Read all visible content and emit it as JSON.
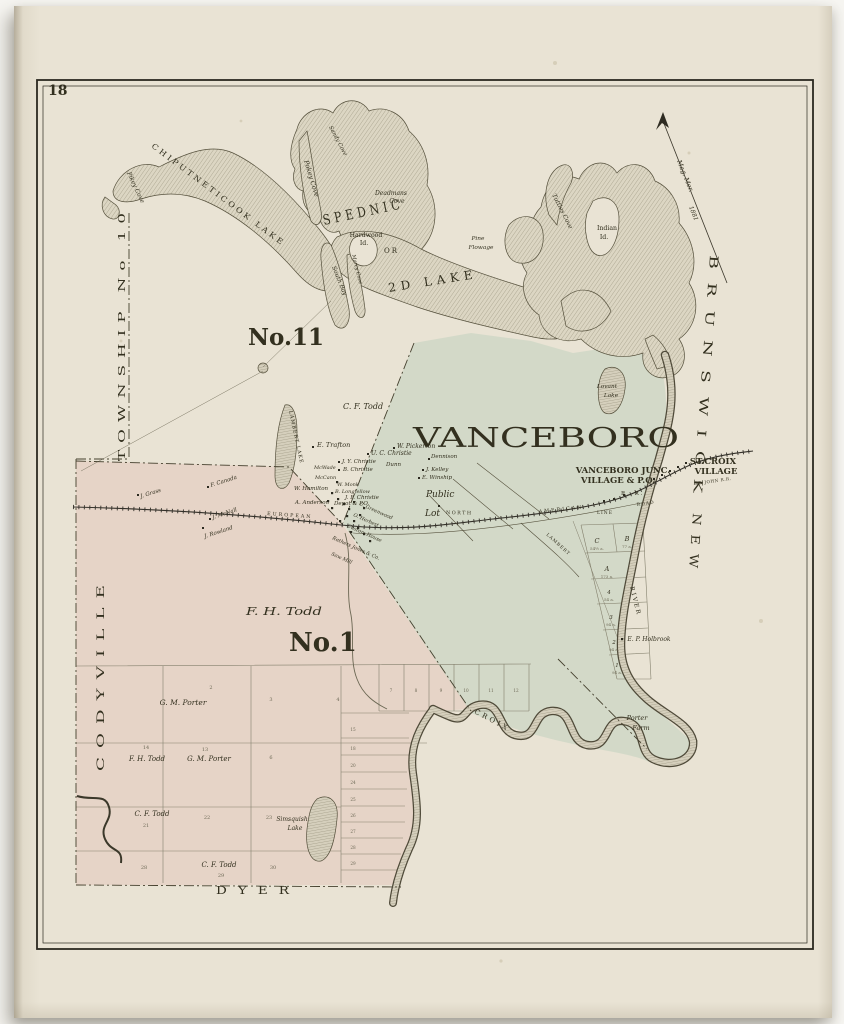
{
  "page": {
    "number": "18"
  },
  "margins": {
    "township_no10": "TOWNSHIP No 10",
    "codyville": "CODYVILLE",
    "dyer": "DYER",
    "brunswick": "BRUNSWICK",
    "new": "NEW"
  },
  "compass": {
    "label": "Mag. Mer.",
    "year": "1881"
  },
  "townships": {
    "no11": "No.11",
    "no1": "No.1",
    "vanceboro": "VANCEBORO",
    "fh_todd": "F. H. Todd",
    "public": "Public",
    "lot": "Lot"
  },
  "villages": {
    "vj1": "VANCEBORO JUNC.",
    "vj2": "VILLAGE & P.O.",
    "sc1": "ST.CROIX",
    "sc2": "VILLAGE"
  },
  "water": {
    "chiputneticook": "CHIPUTNETICOOK LAKE",
    "spednic": "SPEDNIC",
    "or": "OR",
    "second_lake": "2D LAKE",
    "pikey_cove": "Pikey Cove",
    "pokey_cove": "Pokey Cove",
    "sandy_cove": "Sandy Cove",
    "deadmans1": "Deadmans",
    "deadmans2": "Cove",
    "hardwood1": "Hardwood",
    "hardwood2": "Id.",
    "pine1": "Pine",
    "pine2": "Flowage",
    "south_bay": "South Bay",
    "marcy_cove": "Marcy Cove",
    "tuttles_cove": "Tuttles Cove",
    "indian1": "Indian",
    "indian2": "Id.",
    "lovant1": "Lovant",
    "lovant2": "Lake",
    "lambert_lake": "LAMBERT LAKE",
    "simsquish1": "Simsquish",
    "simsquish2": "Lake",
    "croix": "CROIX",
    "river": "RIVER"
  },
  "railroad": {
    "european": "EUROPEAN",
    "north": "NORTH",
    "american": "AMERICAN",
    "rr": "R. R.",
    "road": "ROAD",
    "line": "LINE",
    "lambert": "LAMBERT",
    "st_john": "ST. JOHN R.R."
  },
  "settlers": {
    "cf_todd": "C. F. Todd",
    "e_trafton": "E. Trafton",
    "w_pickerton": "W. Pickerton",
    "uc_christie": "U. C. Christie",
    "dunn": "Dunn",
    "dennison": "Dennison",
    "j_kelley": "J. Kelley",
    "e_winship": "E. Winship",
    "jy_christie": "J. Y. Christie",
    "b_christie": "B. Christie",
    "mcwade": "McWade",
    "mccann": "McCann",
    "w_hamilton": "W. Hamilton",
    "w_monk": "W. Monk",
    "b_longfellow": "B. Longfellow",
    "jf_christie": "J. F. Christie",
    "depot": "Depot & P.O.",
    "a_anderson": "A. Anderson",
    "c_greenwood": "C. Greenwood",
    "o_herbert": "O. Herbert",
    "custom_house": "Custom House",
    "rathers": "Rathers Jones & Co.",
    "saw_mill": "Saw Mill",
    "j_grass": "J. Grass",
    "f_canada": "F. Canada",
    "j_mcnall": "J. McNall",
    "j_rowland": "J. Rowland",
    "ep_holbrook": "E. P. Holbrook",
    "porter1": "Porter",
    "porter2": "Farm"
  },
  "sw_grid": {
    "gm_porter1": "G. M. Porter",
    "fh_todd": "F. H. Todd",
    "gm_porter2": "G. M. Porter",
    "cf_todd1": "C. F. Todd",
    "cf_todd2": "C. F. Todd",
    "numbers": [
      "2",
      "3",
      "4",
      "14",
      "13",
      "6",
      "21",
      "22",
      "23",
      "28",
      "29",
      "30"
    ],
    "strip": [
      "7",
      "8",
      "9",
      "10",
      "11",
      "12"
    ],
    "east": [
      "15",
      "18",
      "20",
      "24",
      "25",
      "26",
      "27",
      "28",
      "29"
    ]
  },
  "village_lots": [
    {
      "id": "C",
      "acres": "54½ a."
    },
    {
      "id": "B",
      "acres": "77 a."
    },
    {
      "id": "A",
      "acres": "173 a."
    },
    {
      "id": "4",
      "acres": "54 a."
    },
    {
      "id": "3",
      "acres": "94 a."
    },
    {
      "id": "2",
      "acres": "94 a."
    },
    {
      "id": "1",
      "acres": "94 a."
    }
  ]
}
